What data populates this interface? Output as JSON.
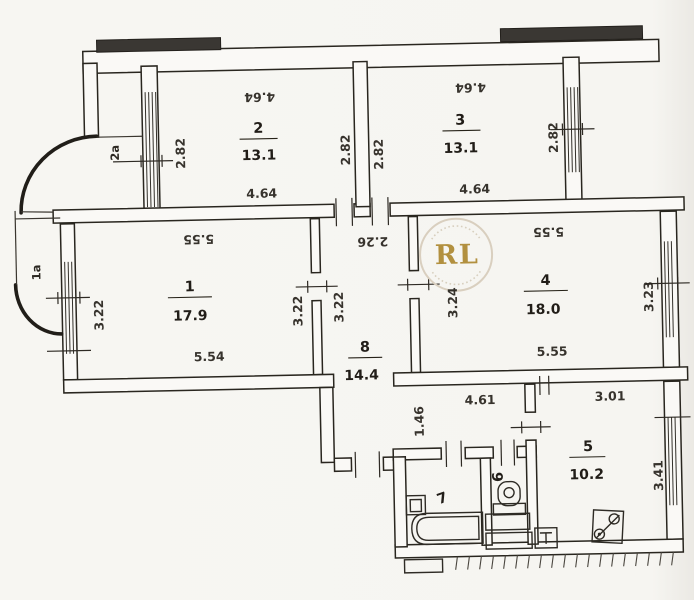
{
  "plan": {
    "watermark": "RL",
    "balconies": {
      "upper": "2а",
      "lower": "1а"
    },
    "rooms": {
      "r1": {
        "num": "1",
        "area": "17.9",
        "top": "5.55",
        "bottom": "5.54",
        "left": "3.22",
        "right": "3.22"
      },
      "r2": {
        "num": "2",
        "area": "13.1",
        "top": "4.64",
        "bottom": "4.64",
        "left": "2.82",
        "right": "2.82"
      },
      "r3": {
        "num": "3",
        "area": "13.1",
        "top": "4.64",
        "bottom": "4.64",
        "left": "2.82",
        "right": "2.82"
      },
      "r4": {
        "num": "4",
        "area": "18.0",
        "top": "5.55",
        "bottom": "5.55",
        "left": "3.24",
        "right": "3.23"
      },
      "r5": {
        "num": "5",
        "area": "10.2",
        "top": "3.01",
        "right": "3.41"
      },
      "r6": {
        "num": "6"
      },
      "r7": {
        "num": "7"
      },
      "r8": {
        "num": "8",
        "area": "14.4",
        "top": "2.26",
        "left": "3.22"
      }
    },
    "hall": {
      "length": "4.61",
      "width": "1.46"
    }
  }
}
